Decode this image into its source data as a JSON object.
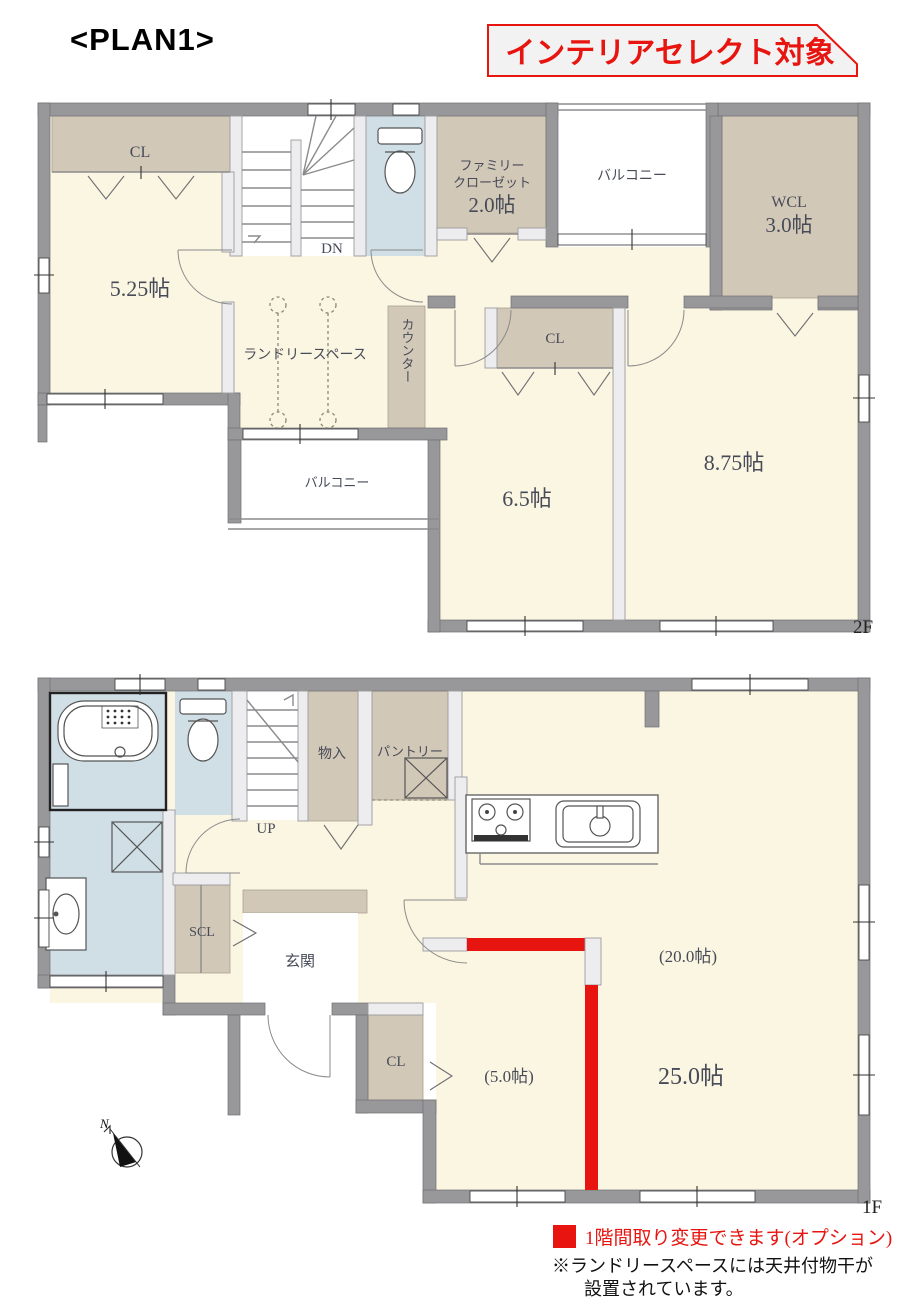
{
  "title": "<PLAN1>",
  "banner": {
    "label": "インテリアセレクト対象"
  },
  "colors": {
    "accent_red": "#e7140f",
    "wall_gray": "#98989b",
    "floor_cream": "#fbf6e2",
    "closet_tan": "#d2c8b7",
    "sanitary_blue": "#d0dfe6",
    "label_ink": "#474b58"
  },
  "floor2": {
    "floor_label": "2F",
    "rooms": {
      "cl_top": "CL",
      "stairs_down": "DN",
      "family_closet": {
        "line1": "ファミリー",
        "line2": "クローゼット",
        "size": "2.0帖"
      },
      "balcony_top": "バルコニー",
      "wcl": {
        "name": "WCL",
        "size": "3.0帖"
      },
      "bedroom_a": "5.25帖",
      "laundry_space": "ランドリースペース",
      "counter": "カウンター",
      "cl_mid": "CL",
      "bedroom_b": "6.5帖",
      "bedroom_c": "8.75帖",
      "balcony_bottom": "バルコニー"
    }
  },
  "floor1": {
    "floor_label": "1F",
    "rooms": {
      "stairs_up": "UP",
      "storage": "物入",
      "pantry": "パントリー",
      "shoe_closet": "SCL",
      "entrance": "玄関",
      "cl": "CL",
      "ldk_partial": "(20.0帖)",
      "room_partial": "(5.0帖)",
      "ldk_total": "25.0帖"
    }
  },
  "compass": {
    "north_label": "N"
  },
  "legend": {
    "label": "1階間取り変更できます(オプション)"
  },
  "footnote": {
    "line1": "※ランドリースペースには天井付物干が",
    "line2": "設置されています。"
  }
}
